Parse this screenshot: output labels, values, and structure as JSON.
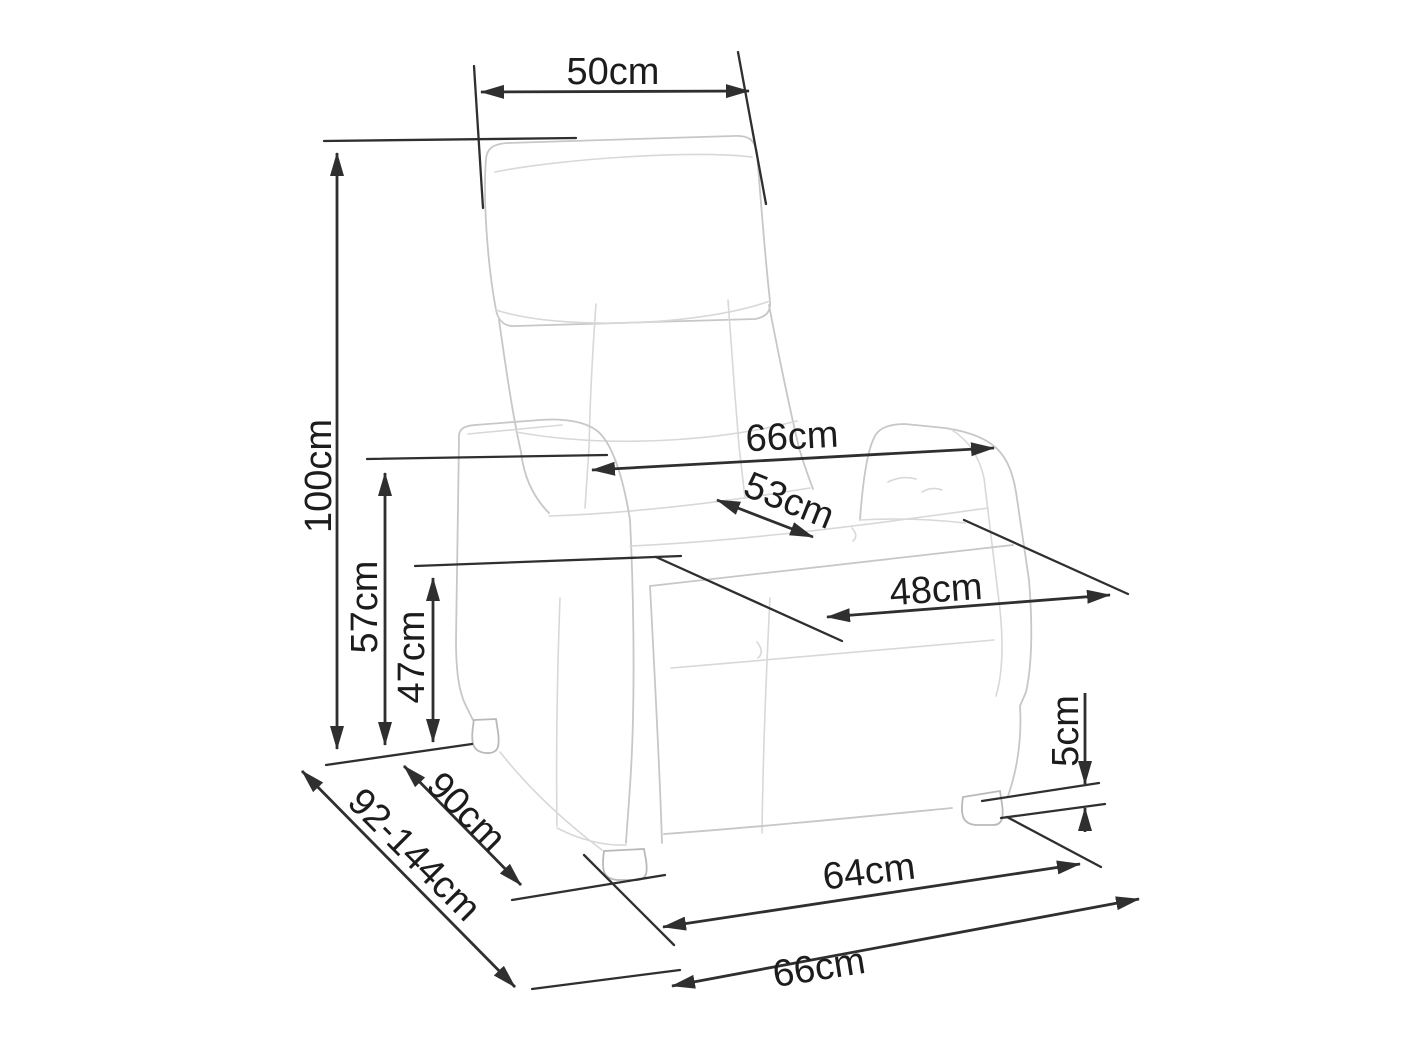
{
  "diagram": {
    "subject": "recliner armchair technical dimension drawing",
    "unit": "cm",
    "colors": {
      "background": "#ffffff",
      "dimension_lines": "#2f2f2f",
      "sketch_lines": "#c7c7c7",
      "text": "#1c1c1c"
    },
    "dimensions": {
      "headrest_width": {
        "label": "50cm",
        "value_cm": 50
      },
      "total_height": {
        "label": "100cm",
        "value_cm": 100
      },
      "width_armrest_outer": {
        "label": "66cm",
        "value_cm": 66
      },
      "seat_width_inner": {
        "label": "53cm",
        "value_cm": 53
      },
      "seat_depth": {
        "label": "48cm",
        "value_cm": 48
      },
      "armrest_height": {
        "label": "57cm",
        "value_cm": 57
      },
      "seat_height": {
        "label": "47cm",
        "value_cm": 47
      },
      "foot_height": {
        "label": "5cm",
        "value_cm": 5
      },
      "depth_base": {
        "label": "90cm",
        "value_cm": 90
      },
      "depth_range": {
        "label": "92-144cm",
        "value_min_cm": 92,
        "value_max_cm": 144
      },
      "base_front_width": {
        "label": "64cm",
        "value_cm": 64
      },
      "overall_width": {
        "label": "66cm",
        "value_cm": 66
      }
    }
  }
}
